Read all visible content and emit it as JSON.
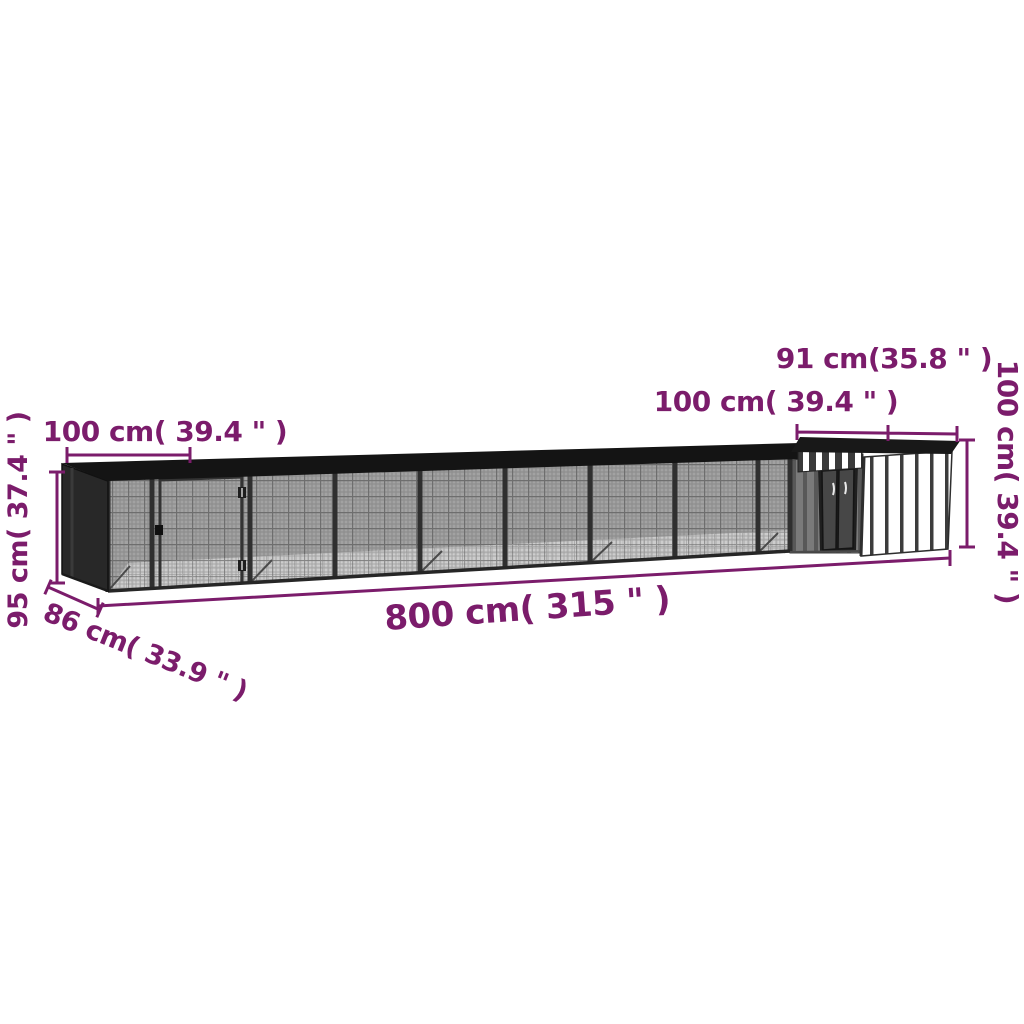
{
  "diagram": {
    "kind": "product-dimension-diagram",
    "subject": "chicken coop run with shed",
    "colors": {
      "dimension_accent": "#7b1c6b",
      "frame_dark": "#1a1a1a",
      "mesh_gray": "#a2a2a2",
      "shed_wall_white": "#ffffff",
      "shed_wall_gray": "#7a7a7a"
    },
    "labels": {
      "panel_width_top_left": "100 cm( 39.4 \" )",
      "height_left": "95 cm( 37.4 \" )",
      "depth_bottom_left": "86 cm( 33.9 \" )",
      "total_length_bottom": "800 cm( 315 \" )",
      "shed_width_top_right": "100 cm( 39.4 \" )",
      "shed_roof_top_right": "91 cm(35.8 \" )",
      "shed_height_right": "100 cm( 39.4 \" )"
    }
  }
}
